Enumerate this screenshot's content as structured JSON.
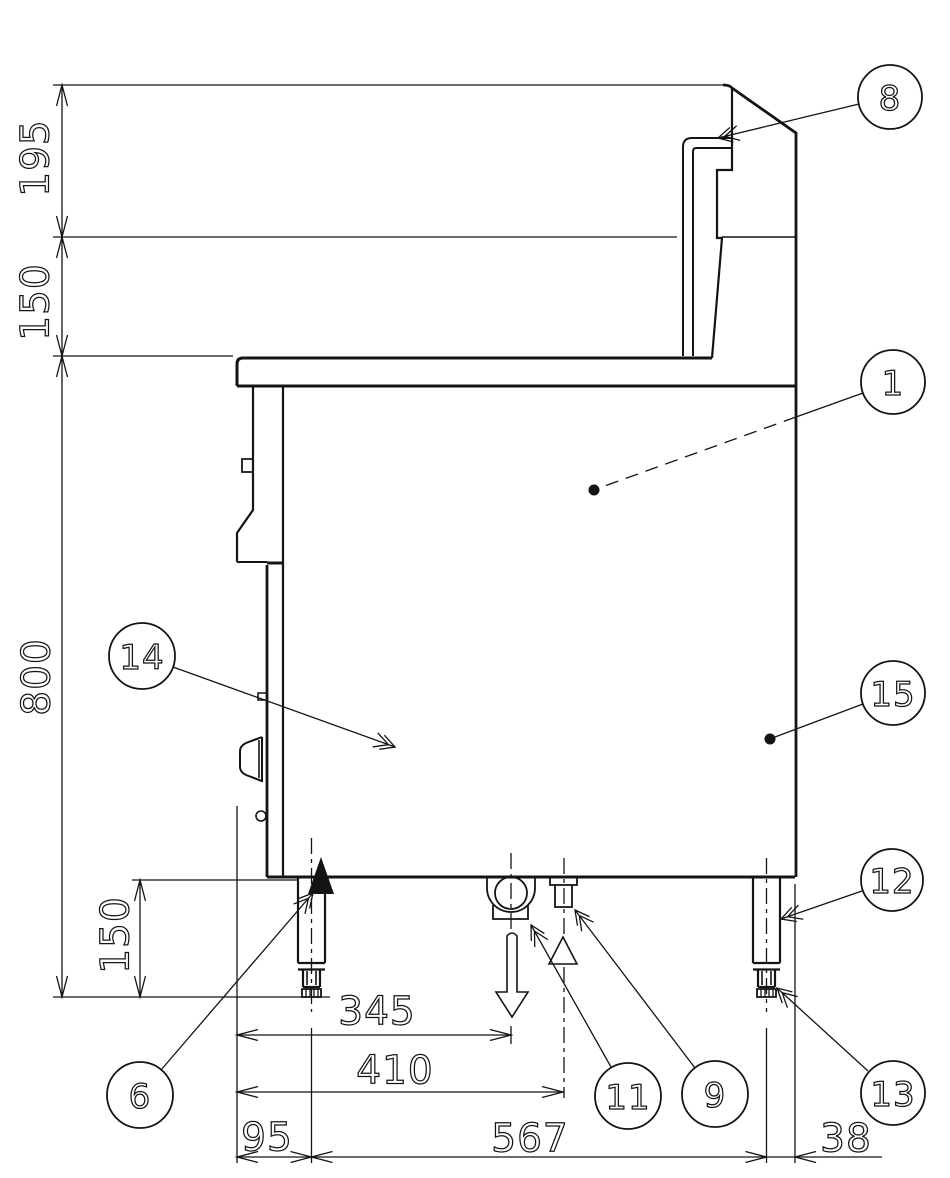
{
  "page": {
    "background": "#ffffff",
    "line_color": "#141414"
  },
  "dimensions": {
    "backsplash_upper_height": "195",
    "backsplash_lower_height": "150",
    "body_height": "800",
    "leg_height": "150",
    "drain_center_offset": "345",
    "gas_center_offset": "410",
    "left_leg_inset": "95",
    "leg_spacing": "567",
    "right_leg_inset": "38"
  },
  "callouts": {
    "backsplash_pipe": "8",
    "body_panel": "1",
    "front_panel": "14",
    "side_panel": "15",
    "leg": "12",
    "leg_mount": "6",
    "drain_outlet": "11",
    "gas_inlet": "9",
    "adjustable_foot": "13"
  }
}
